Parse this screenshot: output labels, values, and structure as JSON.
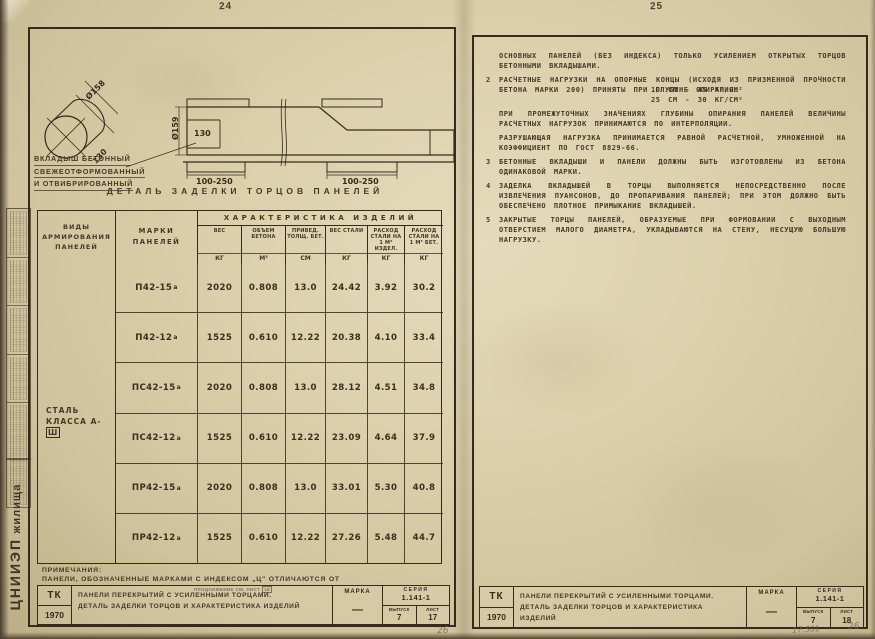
{
  "colors": {
    "paper": "#d8cca9",
    "ink": "#352b1c",
    "typewriter_ink": "#453828",
    "pencil": "#6f6554"
  },
  "stamp_strip": {
    "org_big": "ЦНИИЭП",
    "org_small": "жилища"
  },
  "left_page": {
    "page_number": "24",
    "drawing": {
      "dim_cyl_diameter": "Ø158",
      "dim_cyl_length": "130",
      "dim_section_diameter": "Ø159",
      "dim_section_inner": "130",
      "dim_support_left": "100-250",
      "dim_support_right": "100-250",
      "label_line1": "Вкладыш бетонный",
      "label_line2": "свежеотформованный",
      "label_line3": "и отвибрированный",
      "caption": "Деталь заделки торцов панелей"
    },
    "table": {
      "group_header": "Характеристика изделий",
      "col_types": "Виды армирования панелей",
      "col_marks": "Марки панелей",
      "cols": [
        {
          "name": "Вес",
          "unit": "кг"
        },
        {
          "name": "Объем бетона",
          "unit": "м³"
        },
        {
          "name": "Привед. толщ. бет.",
          "unit": "см"
        },
        {
          "name": "Вес стали",
          "unit": "кг"
        },
        {
          "name": "Расход стали на 1 м² издел.",
          "unit": "кг"
        },
        {
          "name": "Расход стали на 1 м³ бет.",
          "unit": "кг"
        }
      ],
      "steel_class_line1": "Сталь",
      "steel_class_line2": "класса А-",
      "steel_class_boxed": "Ш",
      "rows": [
        {
          "mark": "П42-15",
          "sup": "а",
          "values": [
            "2020",
            "0.808",
            "13.0",
            "24.42",
            "3.92",
            "30.2"
          ]
        },
        {
          "mark": "П42-12",
          "sup": "а",
          "values": [
            "1525",
            "0.610",
            "12.22",
            "20.38",
            "4.10",
            "33.4"
          ]
        },
        {
          "mark": "ПС42-15",
          "sup": "а",
          "values": [
            "2020",
            "0.808",
            "13.0",
            "28.12",
            "4.51",
            "34.8"
          ]
        },
        {
          "mark": "ПС42-12",
          "sup": "а",
          "values": [
            "1525",
            "0.610",
            "12.22",
            "23.09",
            "4.64",
            "37.9"
          ]
        },
        {
          "mark": "ПР42-15",
          "sup": "а",
          "values": [
            "2020",
            "0.808",
            "13.0",
            "33.01",
            "5.30",
            "40.8"
          ]
        },
        {
          "mark": "ПР42-12",
          "sup": "а",
          "values": [
            "1525",
            "0.610",
            "12.22",
            "27.26",
            "5.48",
            "44.7"
          ]
        }
      ]
    },
    "notes": {
      "heading": "Примечания:",
      "line": "Панели, обозначенные марками с индексом „ц\" отличаются от",
      "stamp_text": "продолжение см. лист",
      "stamp_number": "18"
    },
    "titleblock": {
      "org": "ТК",
      "year": "1970",
      "title_line1": "Панели перекрытий с усиленными торцами.",
      "title_line2": "Деталь заделки торцов и характеристика изделий",
      "marka_label": "Марка",
      "marka_value": "—",
      "seriya_label": "Серия",
      "seriya_value": "1.141-1",
      "vypusk_label": "Выпуск",
      "vypusk_value": "7",
      "list_label": "Лист",
      "list_value": "17"
    },
    "pencil_note": "26"
  },
  "right_page": {
    "page_number": "25",
    "paragraphs": [
      {
        "num": "",
        "text": "основных панелей (без индекса) только усилением открытых торцов бетонными вкладышами."
      },
      {
        "num": "2",
        "text": "Расчетные нагрузки на опорные концы (исходя из призменной прочности бетона марки 200) приняты при глубине опирания:",
        "sub": [
          "10 см - 45 кг/см²",
          "25 см - 30 кг/см²"
        ]
      },
      {
        "num": "",
        "text": "При промежуточных значениях глубины опирания панелей величины расчетных нагрузок принимаются по интерполяции."
      },
      {
        "num": "",
        "text": "Разрушающая нагрузка принимается равной расчетной, умноженной на коэффициент по ГОСТ 8829-66."
      },
      {
        "num": "3",
        "text": "Бетонные вкладыши и панели должны быть изготовлены из бетона одинаковой марки."
      },
      {
        "num": "4",
        "text": "Заделка вкладышей в торцы выполняется непосредственно после извлечения пуансонов, до пропаривания панелей; при этом должно быть обеспечено плотное примыкание вкладышей."
      },
      {
        "num": "5",
        "text": "Закрытые торцы панелей, образуемые при формовании с выходным отверстием малого диаметра, укладываются на стену, несущую большую нагрузку."
      }
    ],
    "titleblock": {
      "org": "ТК",
      "year": "1970",
      "title_line1": "Панели перекрытий с усиленными торцами.",
      "title_line2": "Деталь заделки торцов и характеристика изделий",
      "marka_label": "Марка",
      "marka_value": "—",
      "seriya_label": "Серия",
      "seriya_value": "1.141-1",
      "vypusk_label": "Выпуск",
      "vypusk_value": "7",
      "list_label": "Лист",
      "list_value": "18"
    },
    "pencil_note_number": "17.501",
    "pencil_note_sheet": "26"
  }
}
